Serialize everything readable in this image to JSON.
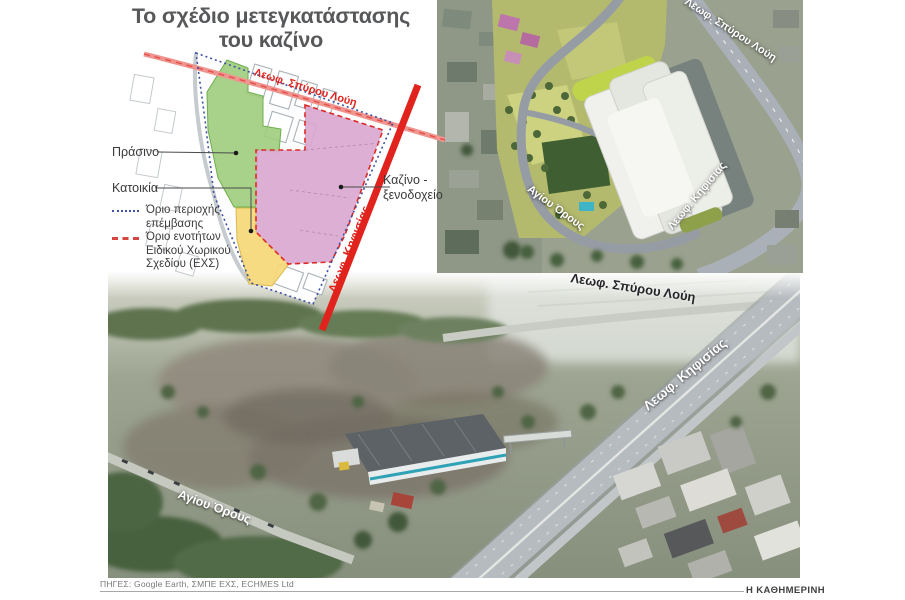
{
  "title": {
    "line1": "Το σχέδιο μετεγκατάστασης",
    "line2": "του καζίνο"
  },
  "plan": {
    "labels": {
      "green": "Πράσινο",
      "residential": "Κατοικία",
      "casino_line1": "Καζίνο -",
      "casino_line2": "ξενοδοχείο",
      "road_top": "Λεωφ. Σπύρου Λούη",
      "road_right": "Λεωφ. Κηφισίας"
    },
    "legend": [
      {
        "style": "blue-dotted",
        "label": "Όριο περιοχής επέμβασης"
      },
      {
        "style": "red-dashed",
        "label": "Όριο ενοτήτων Ειδικού Χωρικού Σχεδίου (ΕΧΣ)"
      }
    ],
    "colors": {
      "green_zone": "#9ecd7c",
      "residential_zone": "#f6d877",
      "casino_zone": "#d9a6cf",
      "main_road": "#e0231d",
      "secondary_road": "#ef948f",
      "boundary_blue": "#3d51a3"
    }
  },
  "render_inset": {
    "labels": {
      "road_top": "Λεωφ. Σπύρου Λούη",
      "road_right": "Λεωφ. Κηφισίας",
      "road_left": "Αγίου Όρους"
    }
  },
  "photo": {
    "labels": {
      "road_top": "Λεωφ. Σπύρου Λούη",
      "road_highway": "Λεωφ. Κηφισίας",
      "road_left": "Αγίου Όρους"
    }
  },
  "footer": {
    "sources": "ΠΗΓΕΣ: Google Earth, ΣΜΠΕ ΕΧΣ, ECHMES Ltd",
    "brand": "Η ΚΑΘΗΜΕΡΙΝΗ"
  }
}
